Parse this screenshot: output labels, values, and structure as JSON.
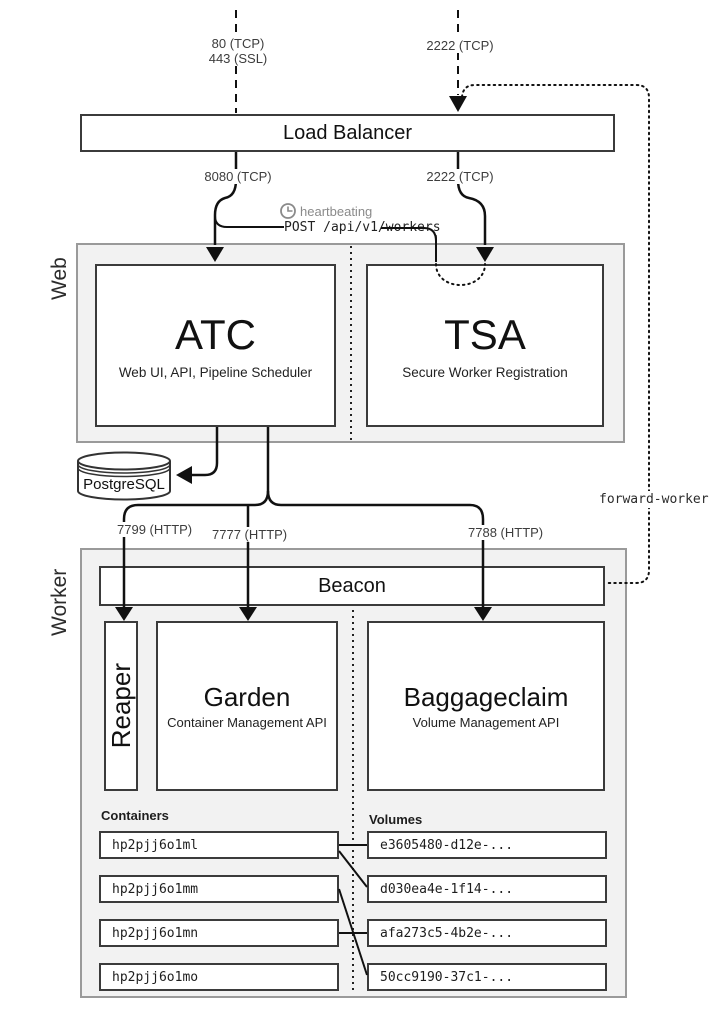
{
  "external": {
    "web_ports": [
      "80 (TCP)",
      "443 (SSL)"
    ],
    "ssh_port": "2222 (TCP)"
  },
  "load_balancer": {
    "title": "Load Balancer",
    "web_port": "8080 (TCP)",
    "ssh_port": "2222 (TCP)"
  },
  "heartbeat": {
    "label": "heartbeating",
    "request": "POST /api/v1/workers"
  },
  "web_group": {
    "label": "Web",
    "atc": {
      "title": "ATC",
      "subtitle": "Web UI, API, Pipeline Scheduler"
    },
    "tsa": {
      "title": "TSA",
      "subtitle": "Secure Worker Registration"
    }
  },
  "database": {
    "title": "PostgreSQL"
  },
  "worker_ports": {
    "reaper": "7799 (HTTP)",
    "garden": "7777 (HTTP)",
    "baggageclaim": "7788 (HTTP)"
  },
  "forward_worker": {
    "label": "forward-worker"
  },
  "worker_group": {
    "label": "Worker",
    "beacon": {
      "title": "Beacon"
    },
    "reaper": {
      "title": "Reaper"
    },
    "garden": {
      "title": "Garden",
      "subtitle": "Container Management API"
    },
    "baggageclaim": {
      "title": "Baggageclaim",
      "subtitle": "Volume Management API"
    },
    "containers": {
      "heading": "Containers",
      "items": [
        "hp2pjj6o1ml",
        "hp2pjj6o1mm",
        "hp2pjj6o1mn",
        "hp2pjj6o1mo"
      ]
    },
    "volumes": {
      "heading": "Volumes",
      "items": [
        "e3605480-d12e-...",
        "d030ea4e-1f14-...",
        "afa273c5-4b2e-...",
        "50cc9190-37c1-..."
      ]
    }
  },
  "colors": {
    "band_fill": "#f2f2f2",
    "band_border": "#9a9a9a",
    "box_border": "#3b3b3b",
    "line": "#111111",
    "muted_text": "#8a8a8a",
    "port_text": "#3d3d3d"
  }
}
